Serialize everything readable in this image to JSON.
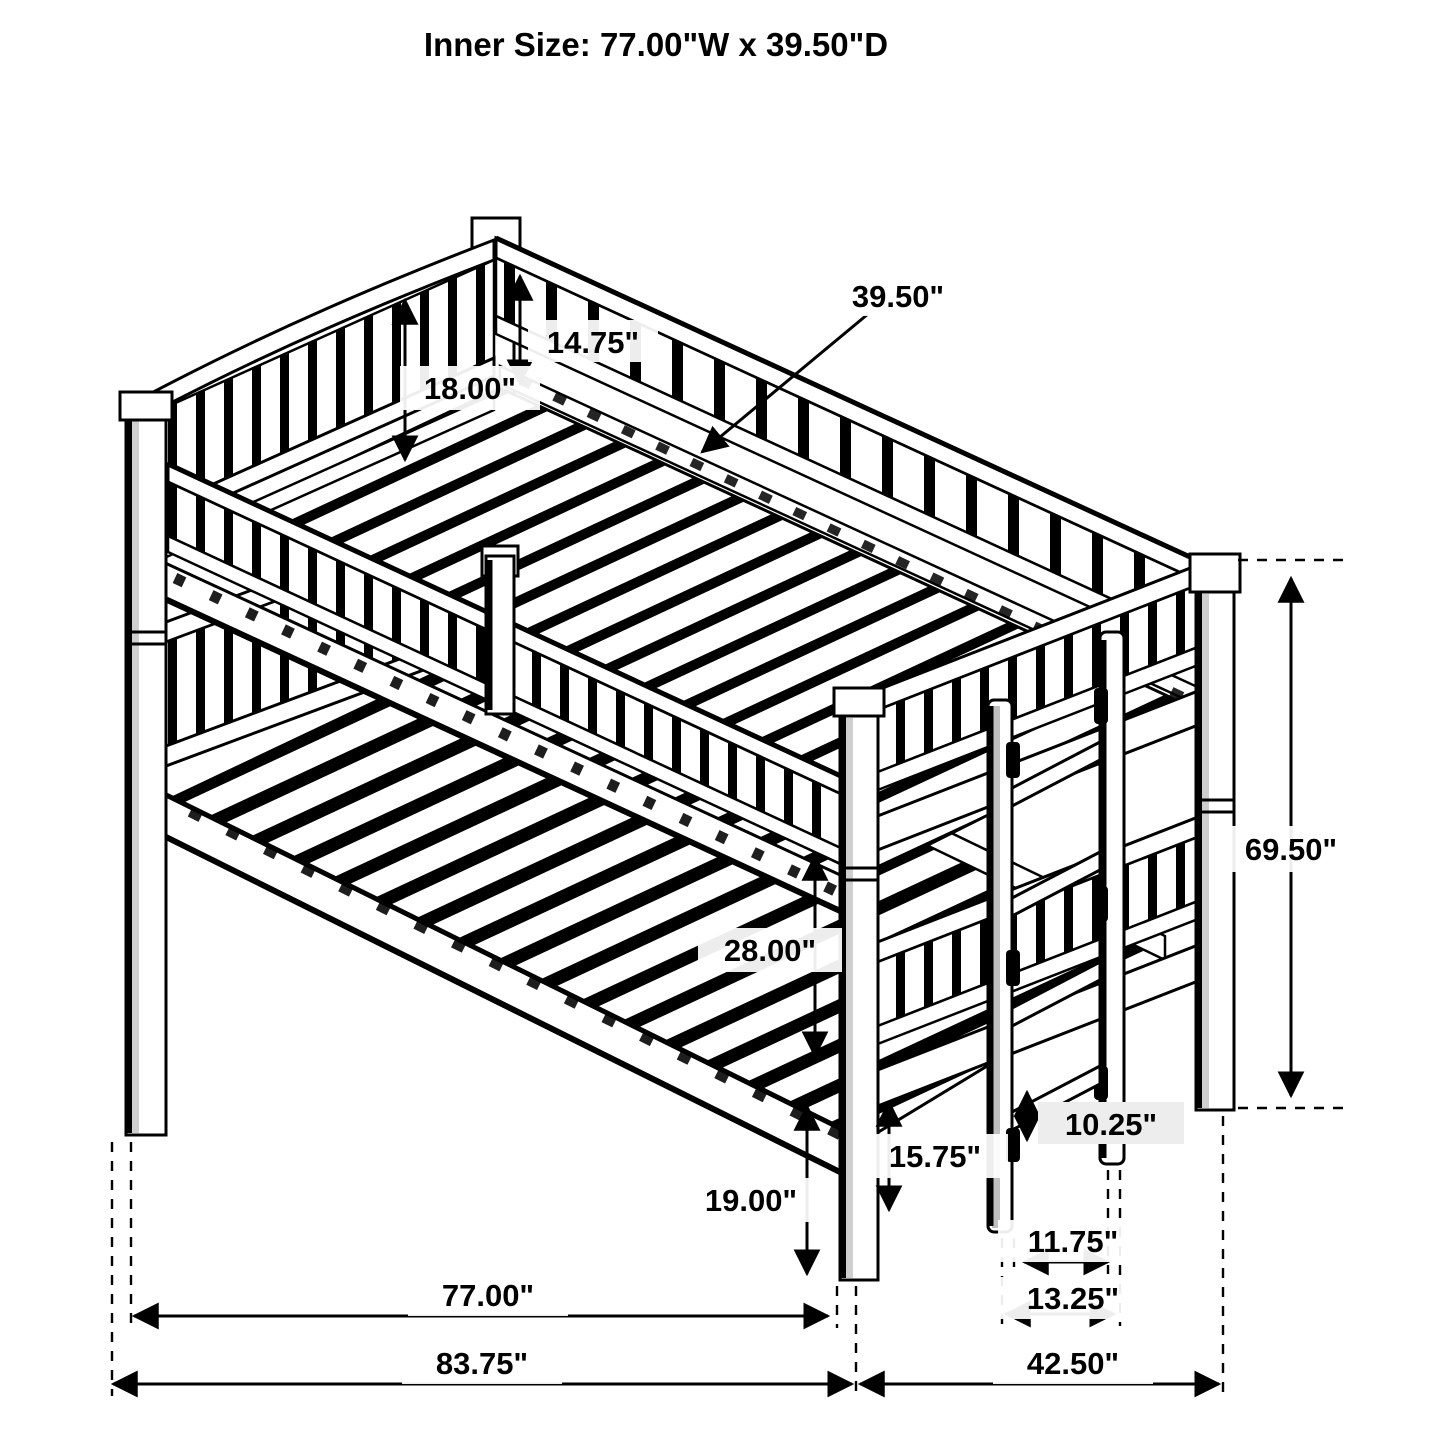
{
  "page": {
    "background": "#ffffff",
    "line_color": "#000000",
    "subject": "bunk-bed-dimension-diagram"
  },
  "title": "Inner Size: 77.00\"W x 39.50\"D",
  "dims": {
    "inner_depth": "39.50\"",
    "guard_height": "14.75\"",
    "headboard_height": "18.00\"",
    "overall_height": "69.50\"",
    "bunk_clearance": "28.00\"",
    "rail_floor_height": "19.00\"",
    "under_clearance": "15.75\"",
    "rung_spacing": "10.25\"",
    "ladder_inner": "11.75\"",
    "ladder_outer": "13.25\"",
    "inner_length": "77.00\"",
    "overall_length": "83.75\"",
    "overall_depth": "42.50\""
  }
}
